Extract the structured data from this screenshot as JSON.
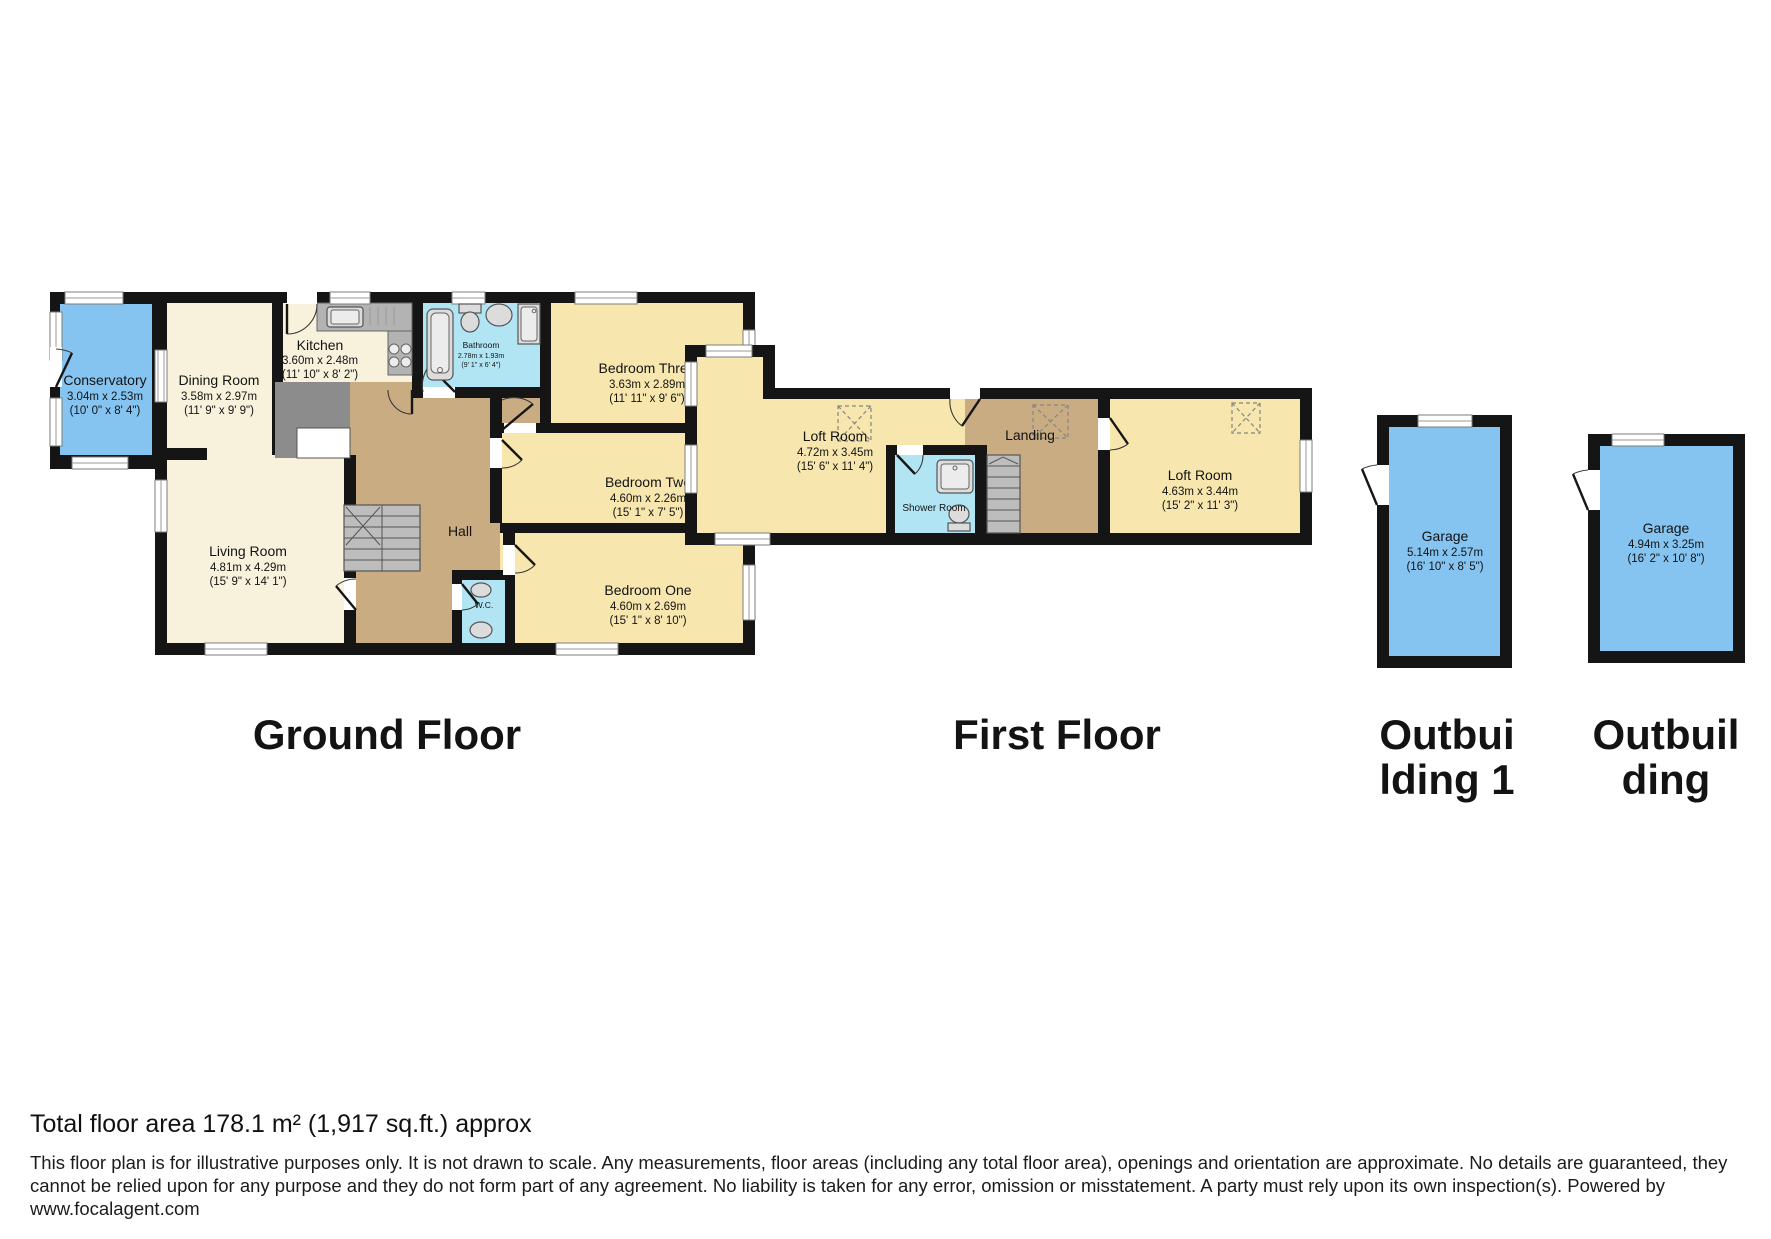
{
  "ground_floor": {
    "title": "Ground Floor",
    "rooms": {
      "conservatory": {
        "name": "Conservatory",
        "metric": "3.04m x 2.53m",
        "imperial": "(10' 0\" x 8' 4\")"
      },
      "dining_room": {
        "name": "Dining Room",
        "metric": "3.58m x 2.97m",
        "imperial": "(11' 9\" x 9' 9\")"
      },
      "kitchen": {
        "name": "Kitchen",
        "metric": "3.60m x 2.48m",
        "imperial": "(11' 10\" x 8' 2\")"
      },
      "bathroom": {
        "name": "Bathroom",
        "metric": "2.78m x 1.93m",
        "imperial": "(9' 1\" x 6' 4\")"
      },
      "bedroom_three": {
        "name": "Bedroom Three",
        "metric": "3.63m x 2.89m",
        "imperial": "(11' 11\" x 9' 6\")"
      },
      "bedroom_two": {
        "name": "Bedroom Two",
        "metric": "4.60m x 2.26m",
        "imperial": "(15' 1\" x 7' 5\")"
      },
      "bedroom_one": {
        "name": "Bedroom One",
        "metric": "4.60m x 2.69m",
        "imperial": "(15' 1\" x 8' 10\")"
      },
      "living_room": {
        "name": "Living Room",
        "metric": "4.81m x 4.29m",
        "imperial": "(15' 9\" x 14' 1\")"
      },
      "hall": {
        "name": "Hall"
      },
      "wc": {
        "name": "W.C."
      }
    }
  },
  "first_floor": {
    "title": "First Floor",
    "rooms": {
      "loft_room_left": {
        "name": "Loft Room",
        "metric": "4.72m x 3.45m",
        "imperial": "(15' 6\" x 11' 4\")"
      },
      "landing": {
        "name": "Landing"
      },
      "shower_room": {
        "name": "Shower Room"
      },
      "loft_room_right": {
        "name": "Loft Room",
        "metric": "4.63m x 3.44m",
        "imperial": "(15' 2\" x 11' 3\")"
      }
    }
  },
  "outbuilding_1": {
    "title": "Outbui\nlding 1",
    "rooms": {
      "garage": {
        "name": "Garage",
        "metric": "5.14m x 2.57m",
        "imperial": "(16' 10\" x 8' 5\")"
      }
    }
  },
  "outbuilding_2": {
    "title": "Outbuil\nding",
    "rooms": {
      "garage": {
        "name": "Garage",
        "metric": "4.94m x 3.25m",
        "imperial": "(16' 2\" x 10' 8\")"
      }
    }
  },
  "footer": {
    "total_area": "Total floor area 178.1 m² (1,917 sq.ft.) approx",
    "disclaimer": "This floor plan is for illustrative purposes only. It is not drawn to scale. Any measurements, floor areas (including any total floor area), openings and orientation are approximate. No details are guaranteed, they cannot be relied upon for any purpose and they do not form part of any agreement. No liability is taken for any error, omission or misstatement. A party must rely upon its own inspection(s). Powered by www.focalagent.com"
  },
  "colors": {
    "wall": "#151515",
    "room_cream": "#F8F2DC",
    "room_yellow": "#F7E7AE",
    "hall_brown": "#C9AC82",
    "wet_room_cyan": "#B2E5F4",
    "conservatory_garage_blue": "#85C3F0"
  }
}
